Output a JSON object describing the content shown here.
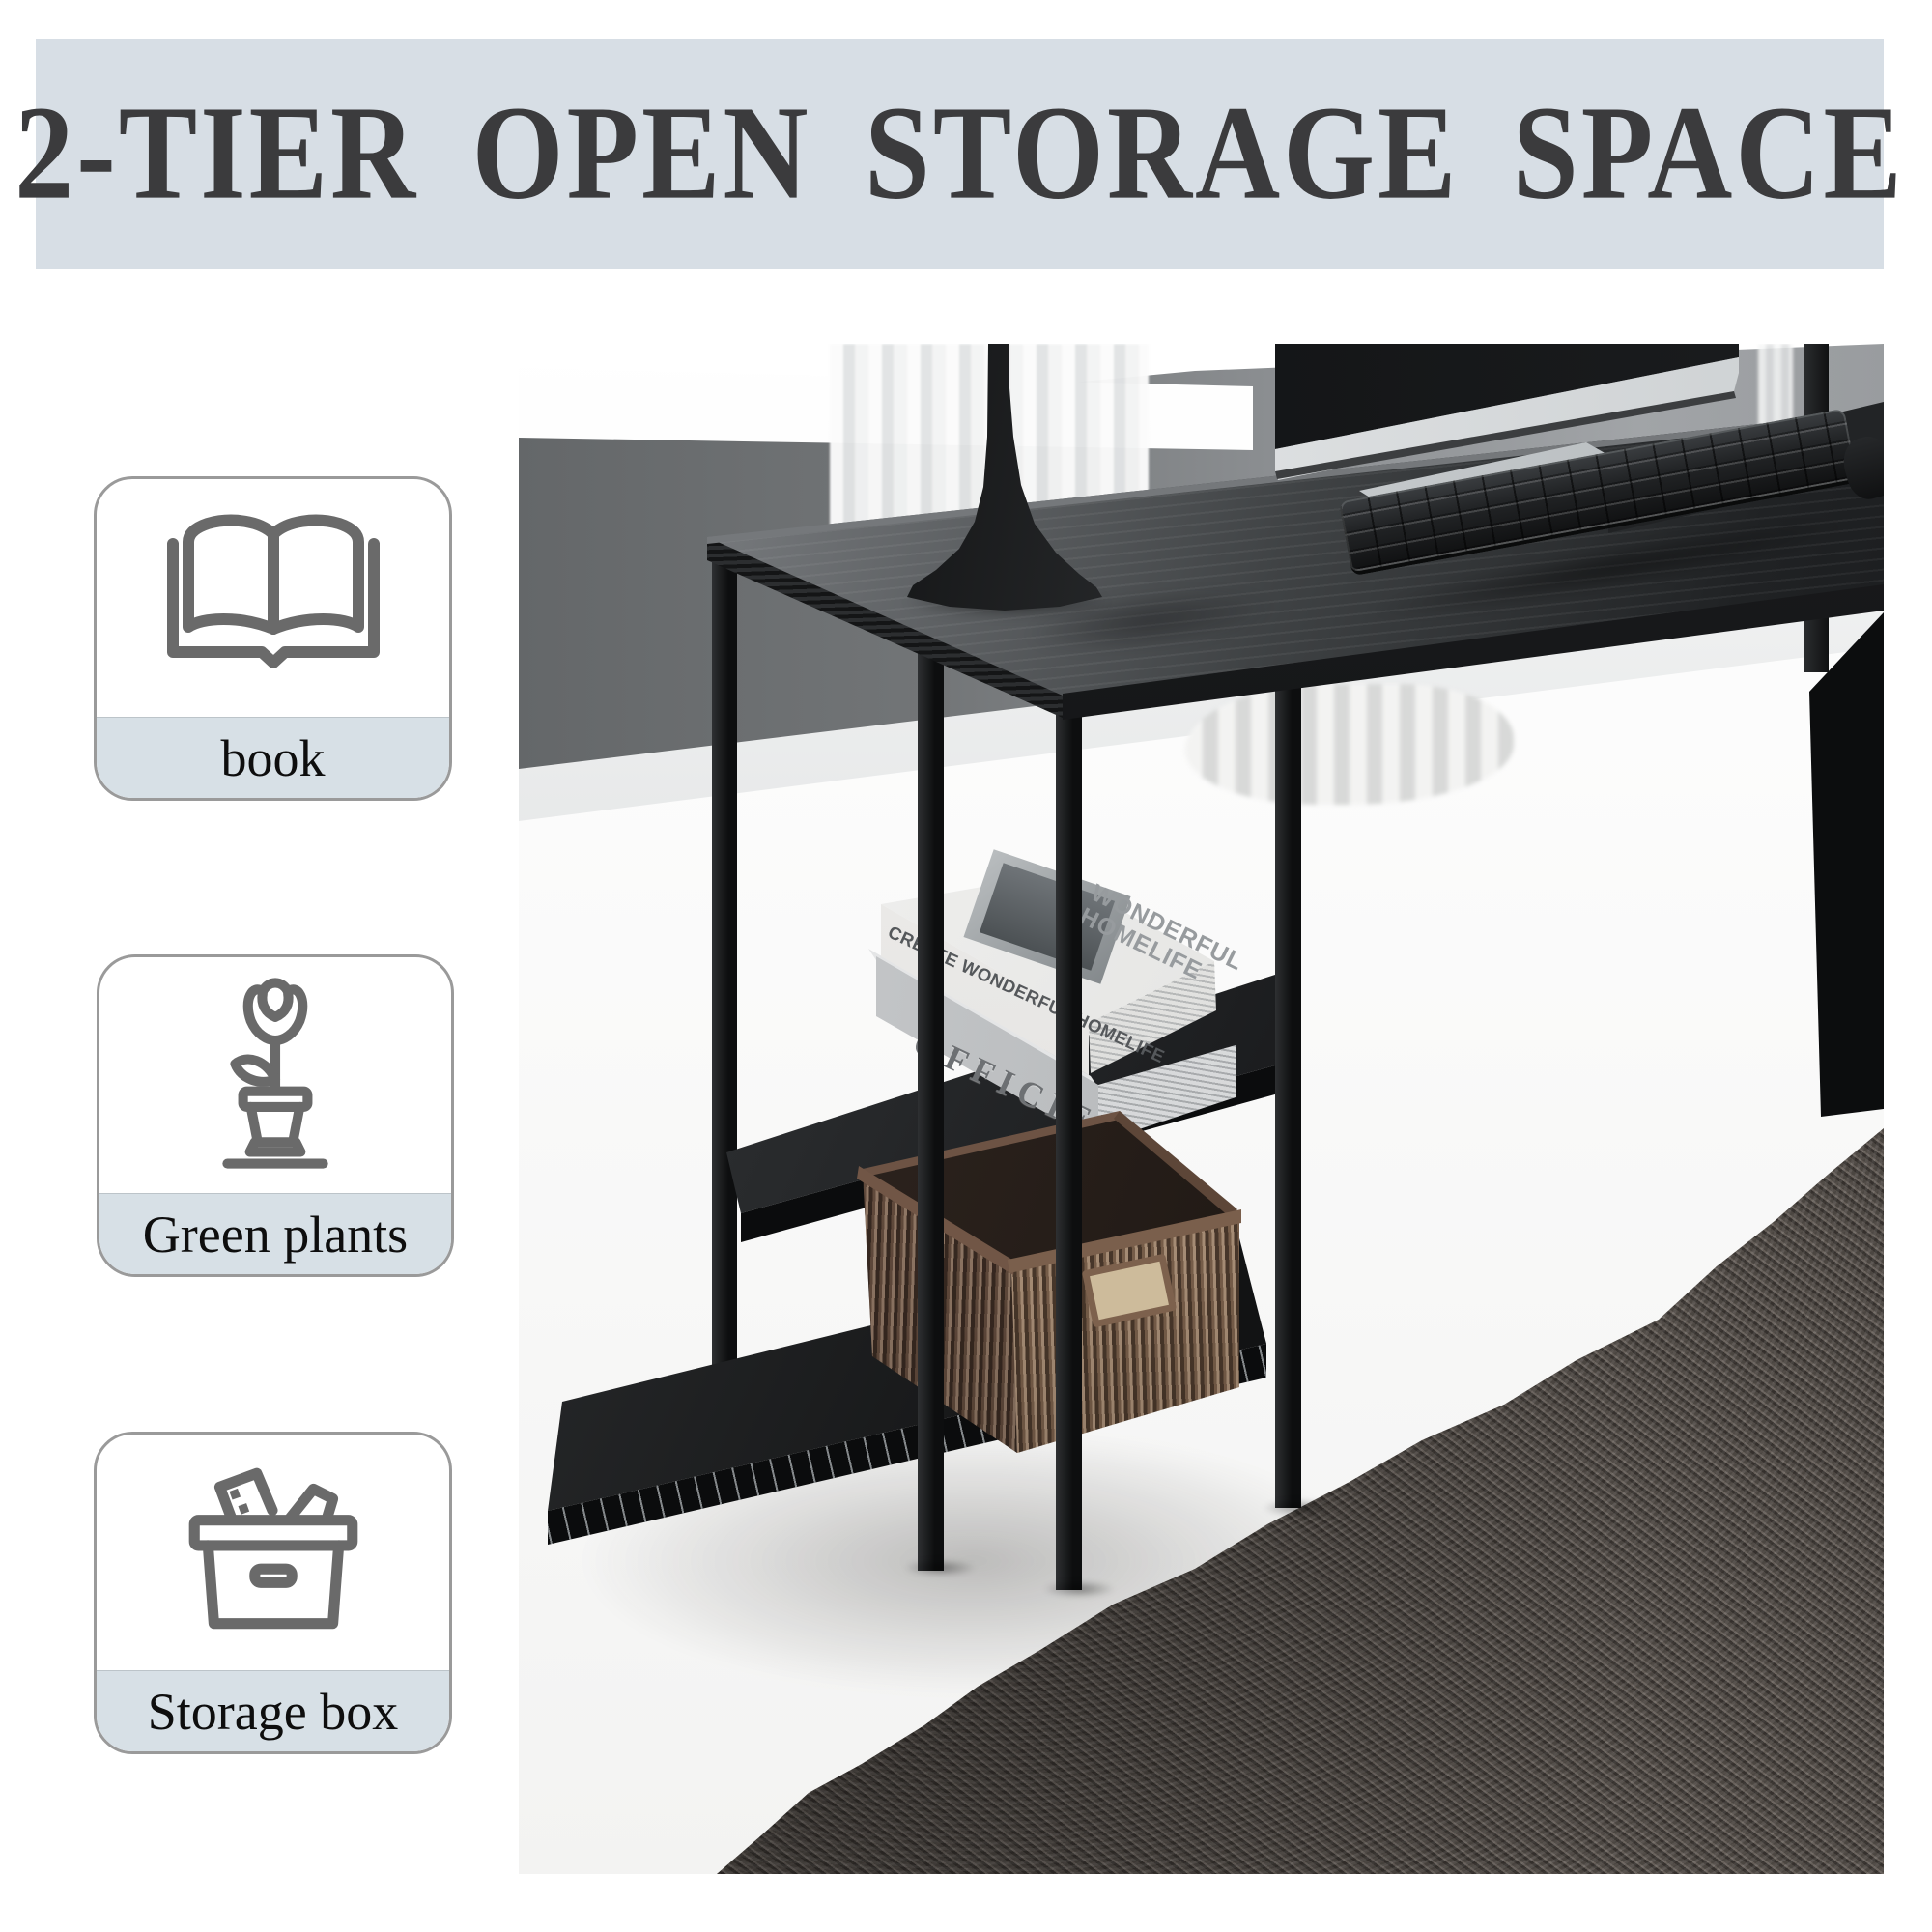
{
  "banner": {
    "title": "2-TIER OPEN STORAGE SPACE"
  },
  "features": [
    {
      "label": "book",
      "icon": "open-book-icon"
    },
    {
      "label": "Green plants",
      "icon": "potted-plant-icon"
    },
    {
      "label": "Storage box",
      "icon": "storage-box-icon"
    }
  ],
  "photo": {
    "book_spine_top": "CREATE WONDERFUL HOMELIFE",
    "book_cover_text": "WONDERFUL HOMELIFE",
    "book_spine_bottom": "OFFICIEL",
    "scene_objects": [
      "gray-wall",
      "white-trim",
      "sheer-curtain",
      "wood-floor",
      "shag-rug",
      "black-desk",
      "2-tier-open-shelves",
      "white-books",
      "woven-storage-basket",
      "black-table-lamp",
      "monitor",
      "keyboard",
      "mouse"
    ]
  },
  "colors": {
    "banner_bg": "#d7dee5",
    "title_text": "#3b3b3d",
    "card_border": "#9a9a9a",
    "card_label_bg": "#d7e0e6",
    "icon_stroke": "#6a6a6a",
    "wall_gray": "#77797c",
    "floor_wood": "#c2bbaf",
    "rug_gray": "#56504b",
    "desk_black": "#141517",
    "basket_brown": "#66503f"
  }
}
